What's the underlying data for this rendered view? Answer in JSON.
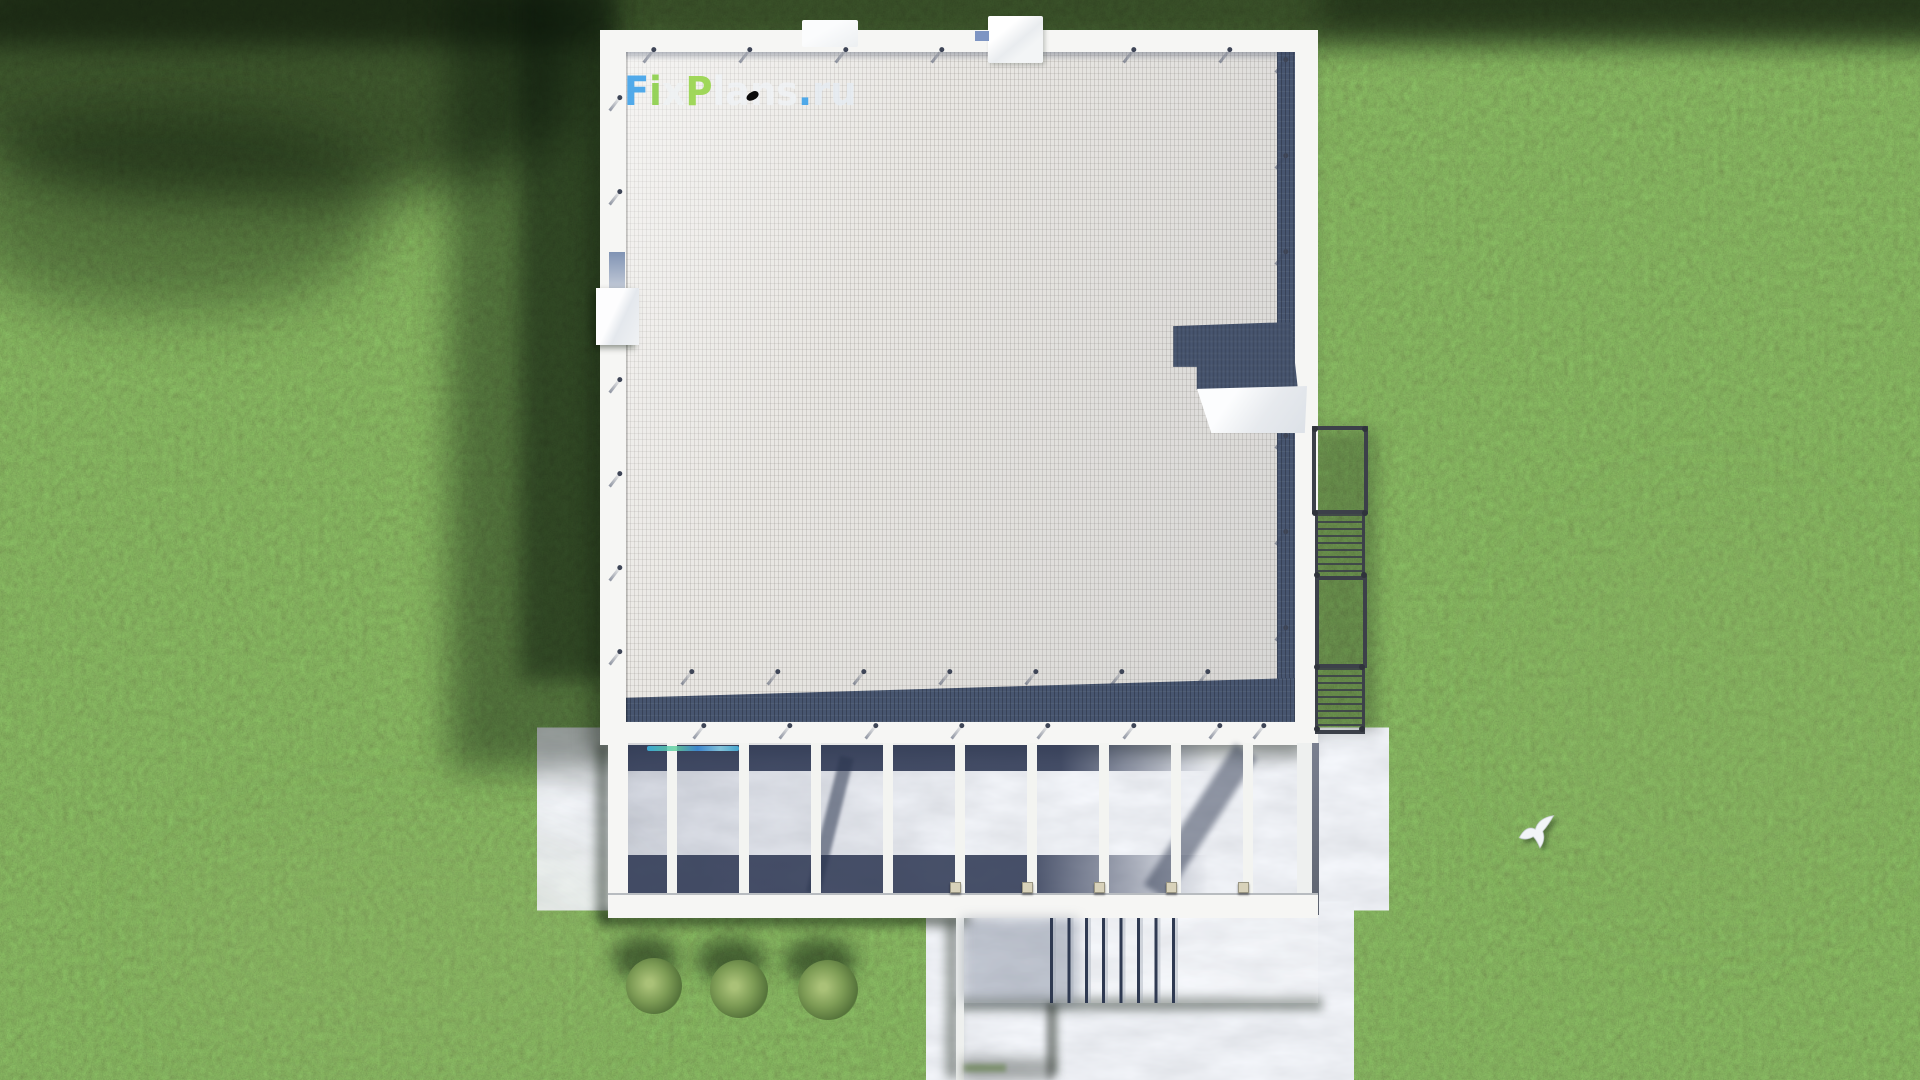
{
  "scene": {
    "watermark": {
      "text": "FixPlans.ru",
      "segments": [
        {
          "text": "F",
          "color": "#45a5ea"
        },
        {
          "text": "i",
          "color": "#8fd14f"
        },
        {
          "text": "x",
          "color": "rgba(238,241,244,0.88)"
        },
        {
          "text": "P",
          "color": "#9ad64f"
        },
        {
          "text": "lans",
          "color": "rgba(238,242,246,0.78)"
        },
        {
          "text": ".",
          "color": "#45a5ea"
        },
        {
          "text": "ru",
          "color": "rgba(228,235,243,0.82)"
        }
      ]
    },
    "palette": {
      "grass-base": "#5a7a43",
      "grass-dark": "#2c441f",
      "forest-shadow": "#0c160a",
      "roof-tile": "#e9e7e3",
      "parapet-white": "#f6f6f4",
      "shadow-navy": "#47556f",
      "terrace-floor": "#c6ccd6",
      "concrete": "#d6d9da",
      "step-dark": "#2f3a52",
      "railing-gray": "#3c4049",
      "bush-green": "#7d9c55",
      "bird-white": "#f2f5f7",
      "cap-cream": "#d8d2ba"
    }
  }
}
